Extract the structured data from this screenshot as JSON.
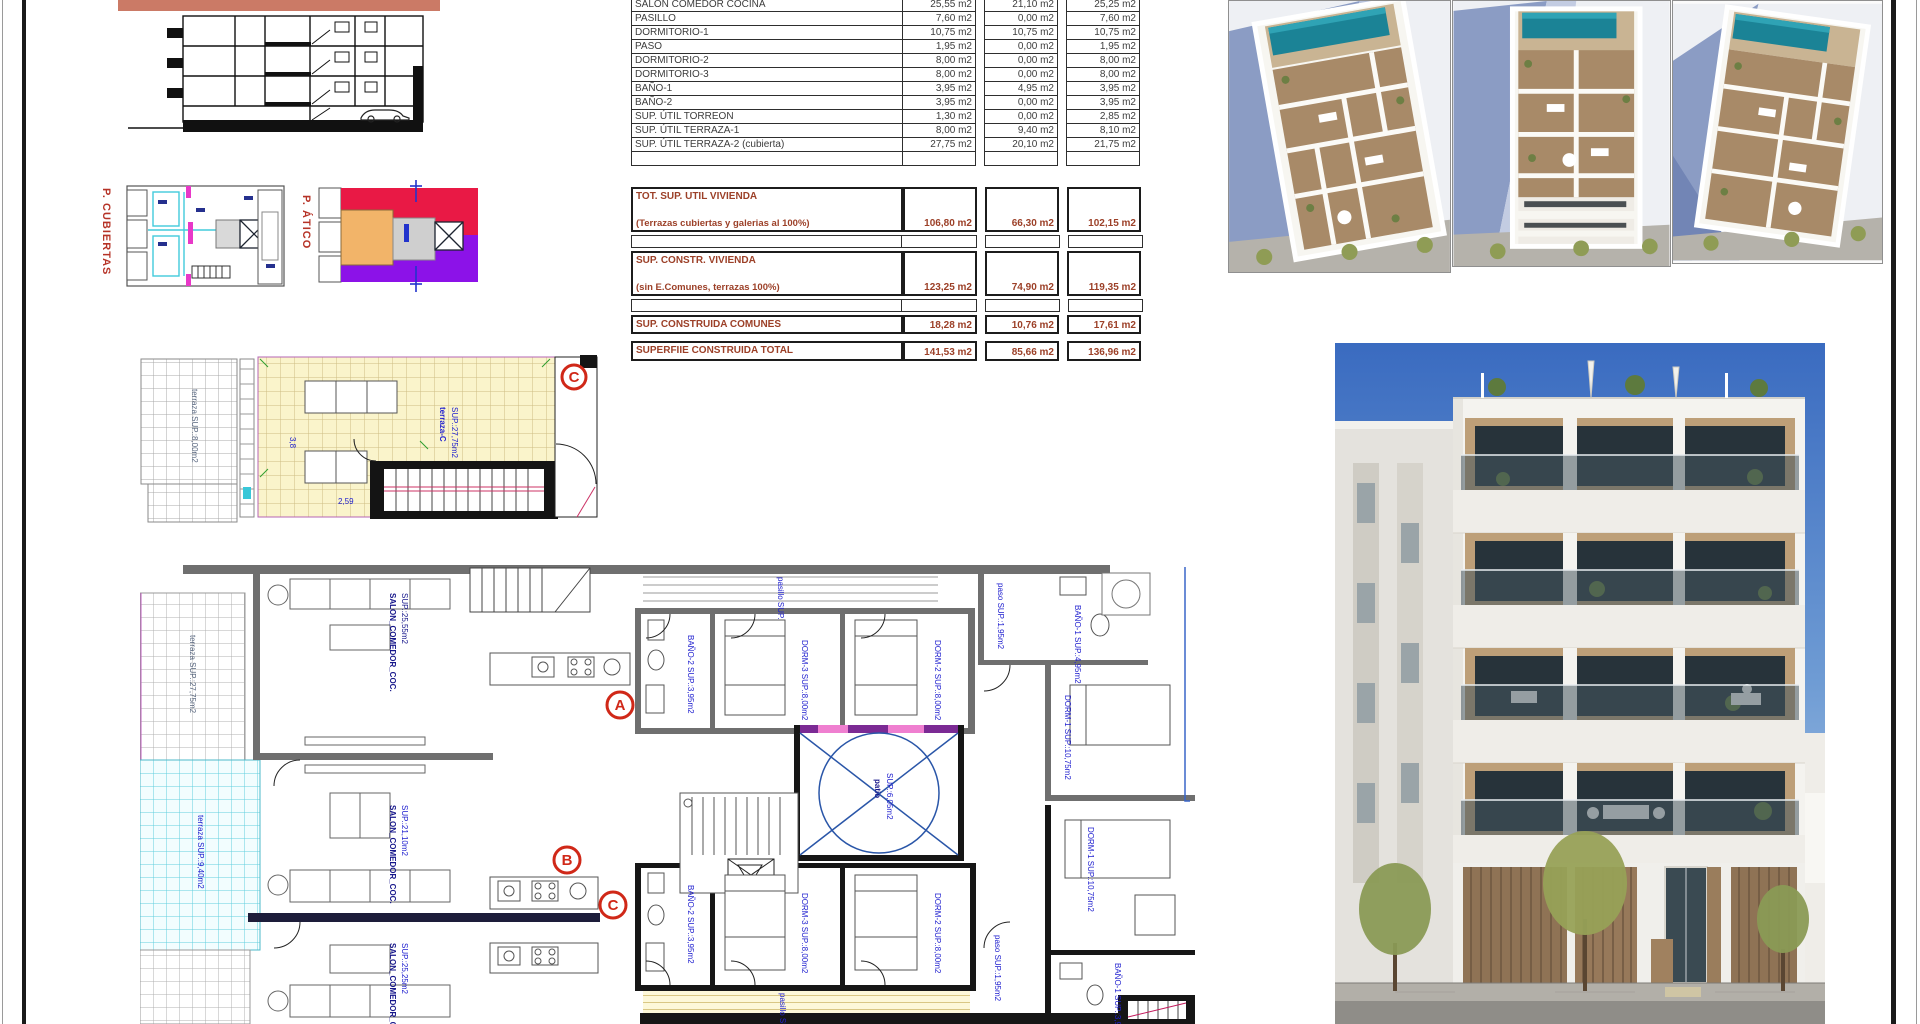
{
  "sheet": {
    "name": "architectural plan sheet"
  },
  "roof_plans": {
    "cubiertas_label": "P. CUBIERTAS",
    "atico_label": "P. ÁTICO"
  },
  "area_table": {
    "rows": [
      {
        "label": "SALON COMEDOR COCINA",
        "values": [
          "25,55 m2",
          "21,10 m2",
          "25,25 m2"
        ]
      },
      {
        "label": "PASILLO",
        "values": [
          "7,60 m2",
          "0,00 m2",
          "7,60 m2"
        ]
      },
      {
        "label": "DORMITORIO-1",
        "values": [
          "10,75 m2",
          "10,75 m2",
          "10,75 m2"
        ]
      },
      {
        "label": "PASO",
        "values": [
          "1,95 m2",
          "0,00 m2",
          "1,95 m2"
        ]
      },
      {
        "label": "DORMITORIO-2",
        "values": [
          "8,00 m2",
          "0,00 m2",
          "8,00 m2"
        ]
      },
      {
        "label": "DORMITORIO-3",
        "values": [
          "8,00 m2",
          "0,00 m2",
          "8,00 m2"
        ]
      },
      {
        "label": "BAÑO-1",
        "values": [
          "3,95 m2",
          "4,95 m2",
          "3,95 m2"
        ]
      },
      {
        "label": "BAÑO-2",
        "values": [
          "3,95 m2",
          "0,00 m2",
          "3,95 m2"
        ]
      },
      {
        "label": "SUP. ÚTIL TORREON",
        "values": [
          "1,30 m2",
          "0,00 m2",
          "2,85 m2"
        ]
      },
      {
        "label": "SUP. ÚTIL TERRAZA-1",
        "values": [
          "8,00 m2",
          "9,40 m2",
          "8,10 m2"
        ]
      },
      {
        "label": "SUP. ÚTIL TERRAZA-2 (cubierta)",
        "values": [
          "27,75 m2",
          "20,10 m2",
          "21,75 m2"
        ]
      }
    ],
    "totals": [
      {
        "label": "TOT. SUP. UTIL VIVIENDA",
        "sublabel": "(Terrazas cubiertas y galerias al 100%)",
        "values": [
          "106,80 m2",
          "66,30 m2",
          "102,15 m2"
        ]
      },
      {
        "label": "SUP. CONSTR. VIVIENDA",
        "sublabel": "(sin E.Comunes, terrazas 100%)",
        "values": [
          "123,25 m2",
          "74,90 m2",
          "119,35 m2"
        ]
      },
      {
        "label": "SUP. CONSTRUIDA COMUNES",
        "sublabel": "",
        "values": [
          "18,28 m2",
          "10,76 m2",
          "17,61 m2"
        ]
      },
      {
        "label": "SUPERFIIE CONSTRUIDA TOTAL",
        "sublabel": "",
        "values": [
          "141,53 m2",
          "85,66 m2",
          "136,96 m2"
        ]
      }
    ]
  },
  "terrace_plan": {
    "marker": "C",
    "label_line1": "terraza-C",
    "label_line2": "SUP.:27,75m2",
    "left_label": "terraza SUP.:8,00m2",
    "dims": [
      "3,8",
      "2,59",
      "1,20",
      "2,18"
    ]
  },
  "floor_plan": {
    "markers": [
      "A",
      "B",
      "C"
    ],
    "rooms": {
      "salon_a": "SALON_COMEDOR_COC.",
      "salon_a_sup": "SUP.:25,55m2",
      "salon_b": "SALON_COMEDOR_COC.",
      "salon_b_sup": "SUP.:21,10m2",
      "salon_c": "SALON_COMEDOR_COC.",
      "salon_c_sup": "SUP.:25,25m2",
      "terraza_a": "terraza SUP.:27,75m2",
      "terraza_b": "terraza SUP.:9,40m2",
      "pasillo_a": "pasillo SUP.:7,60m2",
      "bano2_a": "BAÑO-2 SUP.:3,95m2",
      "dorm3_a": "DORM-3 SUP.:8,00m2",
      "dorm2_a": "DORM-2 SUP.:8,00m2",
      "paso_a": "paso SUP.:1,95m2",
      "bano1_a": "BAÑO-1 SUP.:4,95m2",
      "dorm1_a": "DORM-1 SUP.:10,75m2",
      "patio": "patio",
      "patio_sup": "SUP.:6,05m2",
      "bano2_c": "BAÑO-2 SUP.:3,95m2",
      "dorm3_c": "DORM-3 SUP.:8,00m2",
      "dorm2_c": "DORM-2 SUP.:8,00m2",
      "pasillo_c": "pasillo SUP.:7,60m2",
      "paso_c": "paso SUP.:1,95m2",
      "dorm1_c": "DORM-1 SUP.:10,75m2",
      "bano1_c": "BAÑO-1 SUP.:3,95m2"
    }
  },
  "colors": {
    "salmon_band": "#cb7a66",
    "totals_text": "#9c4028",
    "marker_red": "#d02818",
    "label_blue": "#2020cf",
    "atico_red": "#e91945",
    "atico_purple": "#8c12e8",
    "atico_orange": "#f2b469",
    "cyan_tile": "#62cfdd",
    "pool_teal": "#1b8396",
    "sky_blue": "#4274c4",
    "wall_gray": "#6f6f6f",
    "yellow_tile": "#faf4cb"
  }
}
